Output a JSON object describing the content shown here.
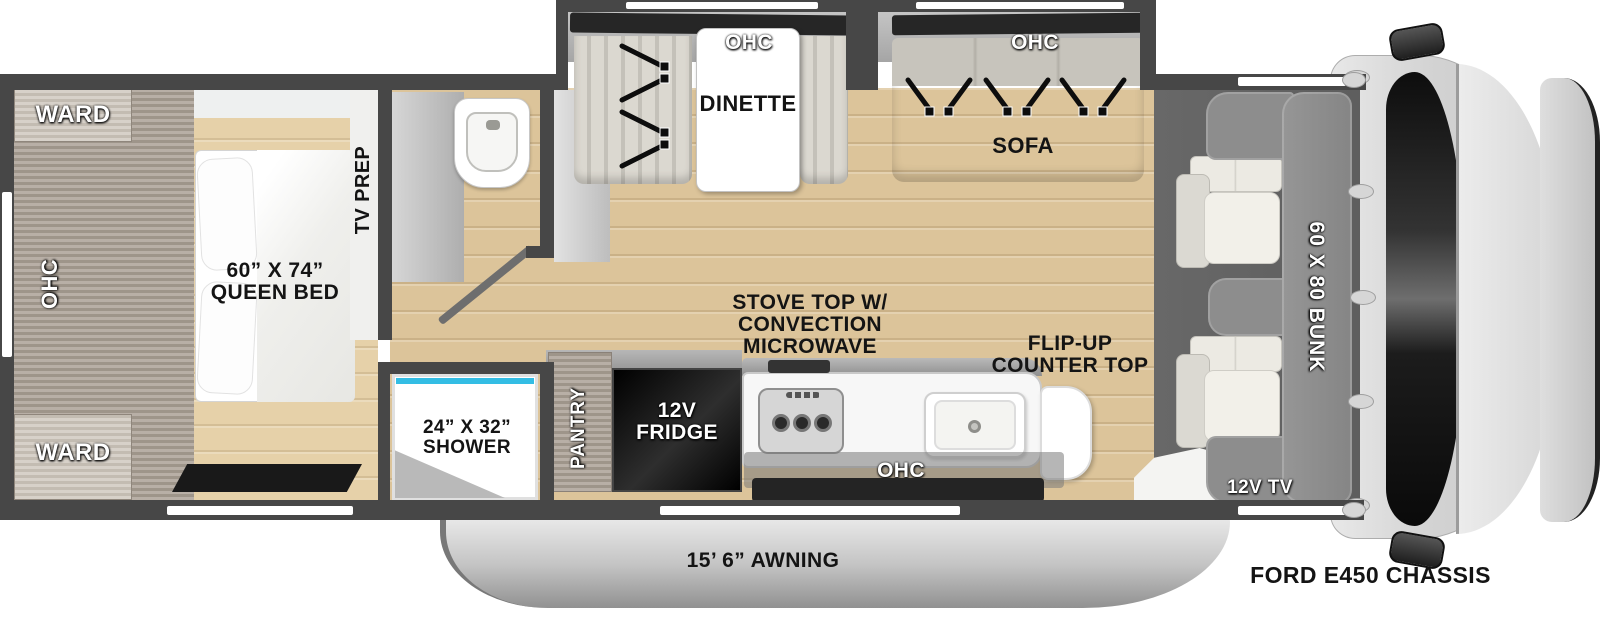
{
  "vehicle": {
    "chassis_label": "FORD E450 CHASSIS",
    "awning_label": "15’ 6” AWNING"
  },
  "bedroom": {
    "ward_top_label": "WARD",
    "ward_bottom_label": "WARD",
    "ohc_label": "OHC",
    "queen_bed_label": "60” X 74”\nQUEEN BED",
    "tv_prep_label": "TV PREP"
  },
  "bathroom": {
    "shower_label": "24” X 32”\nSHOWER"
  },
  "dinette": {
    "ohc_label": "OHC",
    "label": "DINETTE",
    "seatbelt_count": 2
  },
  "sofa": {
    "ohc_label": "OHC",
    "label": "SOFA",
    "seatbelt_count": 3
  },
  "kitchen": {
    "pantry_label": "PANTRY",
    "fridge_label": "12V\nFRIDGE",
    "stove_label": "STOVE TOP W/\nCONVECTION\nMICROWAVE",
    "flip_up_label": "FLIP-UP\nCOUNTER TOP",
    "ohc_label": "OHC"
  },
  "cab": {
    "bunk_label": "60 X 80 BUNK",
    "tv_label": "12V TV"
  },
  "colors": {
    "wall": "#474747",
    "floorMain": "#dcc49a",
    "floorBedroom": "#e6d1a9",
    "cabinetWood": "#aaa095",
    "cabinetFace": "#cdc6bc",
    "cabFloor": "#5e5e5e",
    "bunk": "#8d8d8d",
    "fridge": "#0c0c0c",
    "showerAccent": "#33bde4",
    "rug": "#191919",
    "windshield": "#151515",
    "hood": "#d9d9d9",
    "awning": "#c4c4c4",
    "labelDark": "#141414"
  }
}
